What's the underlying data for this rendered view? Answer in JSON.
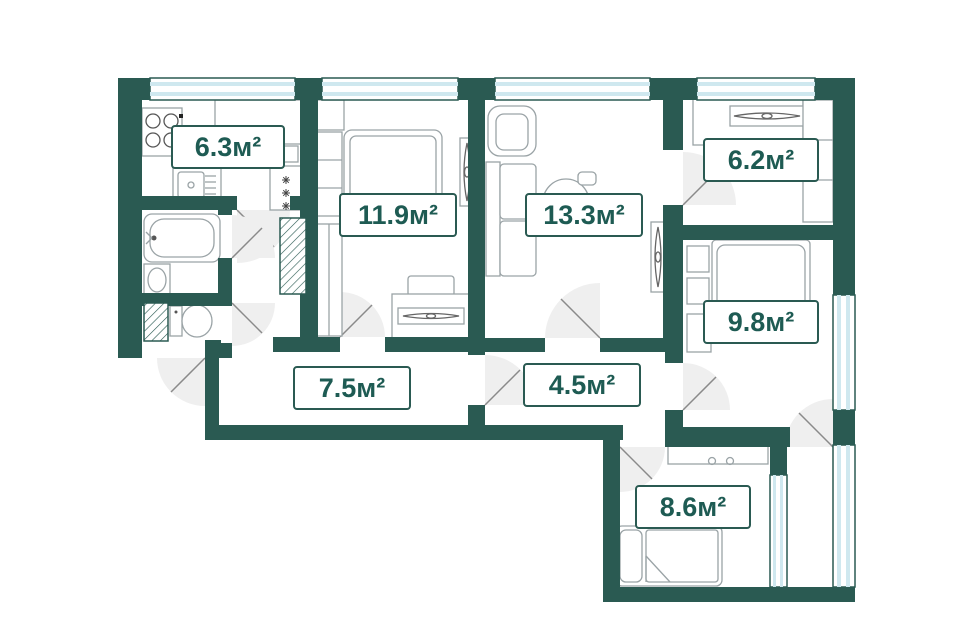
{
  "plan_type": "apartment-floor-plan",
  "units": "м²",
  "colors": {
    "wall": "#2a5a52",
    "window_glass": "#cfe8ef",
    "label_text": "#1e5b53",
    "door_arc": "#efefef",
    "furniture_stroke": "#9aa3a6"
  },
  "rooms": [
    {
      "name": "kitchen",
      "area": "6.3м²"
    },
    {
      "name": "bedroom-1",
      "area": "11.9м²"
    },
    {
      "name": "living-room",
      "area": "13.3м²"
    },
    {
      "name": "cabinet",
      "area": "6.2м²"
    },
    {
      "name": "bedroom-2",
      "area": "9.8м²"
    },
    {
      "name": "hallway",
      "area": "7.5м²"
    },
    {
      "name": "corridor",
      "area": "4.5м²"
    },
    {
      "name": "bedroom-3",
      "area": "8.6м²"
    }
  ]
}
